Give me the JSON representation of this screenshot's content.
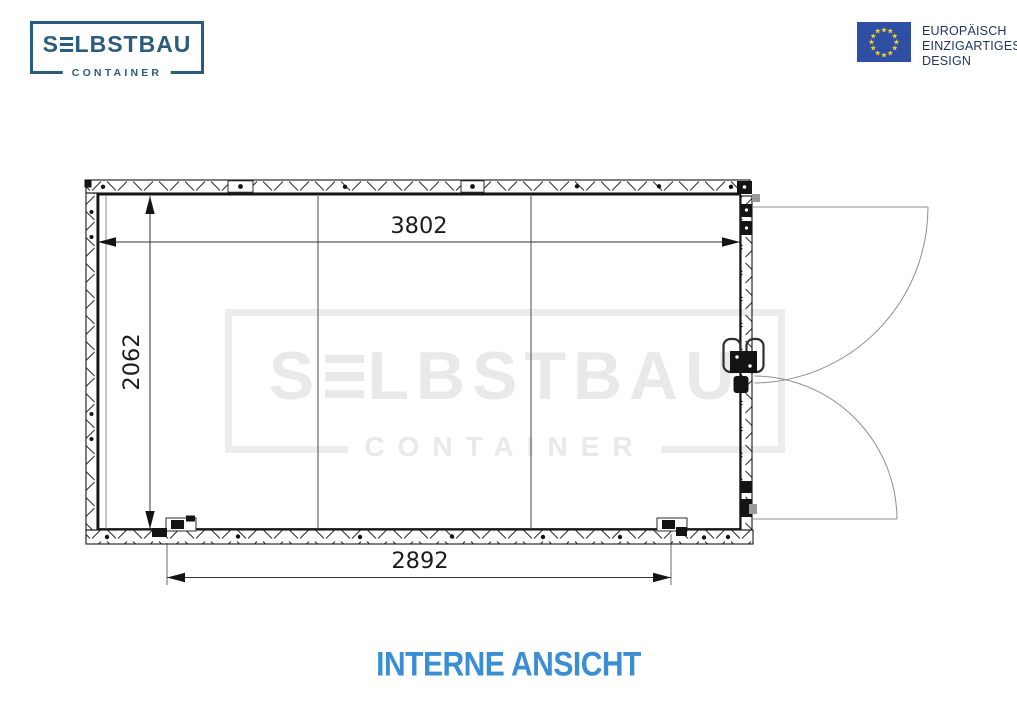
{
  "brand": {
    "name": "SELBSTBAU",
    "name_first": "S",
    "name_rest": "LBSTBAU",
    "subtitle": "CONTAINER"
  },
  "eu_badge": {
    "lines": [
      "EUROPÄISCH",
      "EINZIGARTIGES",
      "DESIGN"
    ]
  },
  "watermark": {
    "name_first": "S",
    "name_rest": "LBSTBAU",
    "subtitle": "CONTAINER"
  },
  "drawing": {
    "dimensions": {
      "interior_width": "3802",
      "interior_height": "2062",
      "door_clearance_width": "2892"
    }
  },
  "title": {
    "text": "INTERNE ANSICHT"
  },
  "colors": {
    "accent_blue": "#3B8ED3",
    "brand_navy": "#2A5C7D",
    "eu_flag_blue": "#2E4FA3",
    "eu_star_yellow": "#F5D22D",
    "line_black": "#141414",
    "watermark_gray": "#EAEAEA"
  }
}
